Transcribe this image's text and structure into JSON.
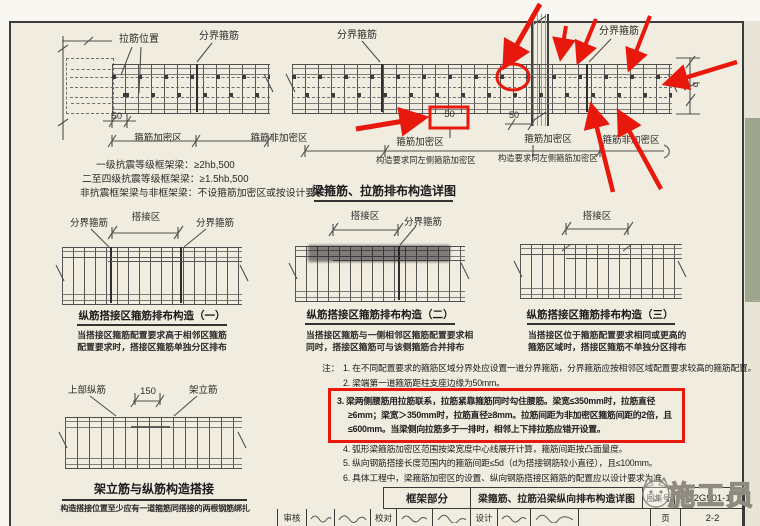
{
  "beam_detail_title": "梁箍筋、拉筋排布构造详图",
  "tl": {
    "tie_position": "拉筋位置",
    "boundary": "分界箍筋",
    "dim50": "50",
    "zone_dense": "箍筋加密区",
    "zone_nondense": "箍筋非加密区",
    "rule1": "一级抗震等级框架梁：≥2hb,500",
    "rule2": "二至四级抗震等级框架梁：≥1.5hb,500",
    "rule3": "非抗震框架梁与非框架梁：不设箍筋加密区或按设计要求"
  },
  "tr": {
    "boundary_left": "分界箍筋",
    "boundary_right": "分界箍筋",
    "dim50_boxed": "50",
    "dim50": "50",
    "zone_dense_left": "箍筋加密区",
    "note_left": "构造要求同左侧箍筋加密区",
    "zone_dense_right": "箍筋加密区",
    "note_right": "构造要求同左侧箍筋加密区",
    "zone_nondense": "箍筋非加密区",
    "dim_b": "b"
  },
  "lap": [
    {
      "bl": "分界箍筋",
      "lz": "搭接区",
      "br": "分界箍筋",
      "title": "纵筋搭接区箍筋排布构造（一）",
      "c1": "当搭接区箍筋配置要求高于相邻区箍筋",
      "c2": "配置要求时，搭接区箍筋单独分区排布"
    },
    {
      "lz": "搭接区",
      "br": "分界箍筋",
      "title": "纵筋搭接区箍筋排布构造（二）",
      "c1": "当搭接区箍筋与一侧相邻区箍筋配置要求相",
      "c2": "同时，搭接区箍筋可与该侧箍筋合并排布"
    },
    {
      "lz": "搭接区",
      "title": "纵筋搭接区箍筋排布构造（三）",
      "c1": "当搭接区位于箍筋配置要求相同或更高的",
      "c2": "箍筋区域时，搭接区箍筋不单独分区排布"
    }
  ],
  "notes": {
    "prefix": "注：",
    "n1": "1. 在不同配置要求的箍筋区域分界处应设置一道分界箍筋，分界箍筋应按相邻区域配置要求较高的箍筋配置。",
    "n2": "2. 梁端第一道箍筋距柱支座边缘为50mm。",
    "n3": "3. 梁两侧腰筋用拉筋联系，拉筋紧靠箍筋同时勾住腰筋。梁宽≤350mm时，拉筋直径≥6mm；梁宽＞350mm时，拉筋直径≥8mm。拉筋间距为非加密区箍筋间距的2倍，且≤600mm。当梁侧向拉筋多于一排时，相邻上下排拉筋应错开设置。",
    "n4": "4. 弧形梁箍筋加密区范围按梁宽度中心线展开计算，箍筋间距按凸面量度。",
    "n5": "5. 纵向钢筋搭接长度范围内的箍筋间距≤5d（d为搭接钢筋较小直径），且≤100mm。",
    "n6": "6. 具体工程中，梁箍筋加密区的设置、纵向钢筋搭接区箍筋的配置应以设计要求为准。"
  },
  "erect": {
    "top_bar": "上部纵筋",
    "dim150": "150",
    "frame_bar": "架立筋",
    "title": "架立筋与纵筋构造搭接",
    "caption": "构造搭接位置至少应有一道箍筋同搭接的两根钢筋绑扎"
  },
  "title_block": {
    "section": "框架部分",
    "sheet_title": "梁箍筋、拉筋沿梁纵向排布构造详图",
    "atlas_label": "图集号",
    "atlas_no": "12G901-1",
    "review": "审核",
    "proof": "校对",
    "design": "设计",
    "page_label": "页",
    "page_no": "2-2"
  },
  "watermark": {
    "text": "施工员"
  }
}
